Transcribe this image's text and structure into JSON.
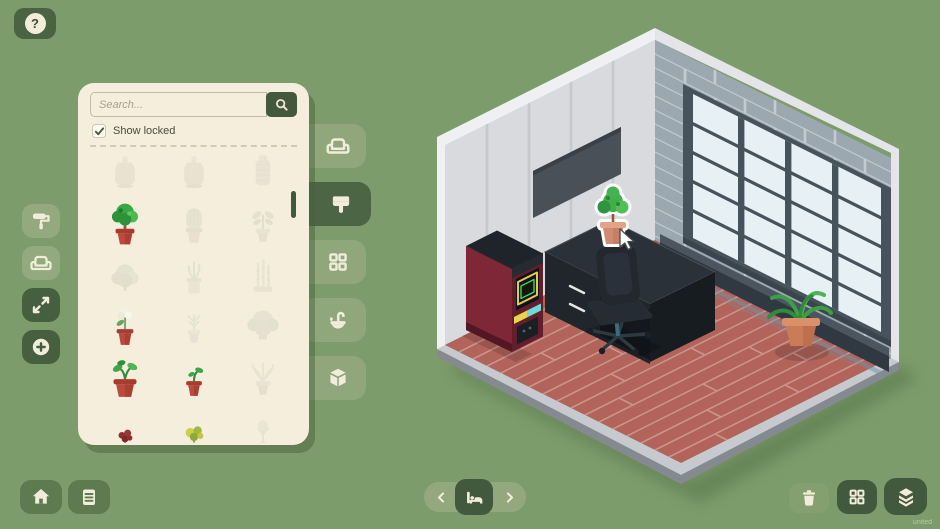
{
  "colors": {
    "background": "#7D9C6B",
    "panel": "#F6EEDD",
    "dark_green": "#46603F",
    "mid_green": "#92AA7D",
    "pot_red": "#B94A3D",
    "floor_brick": "#B2635A",
    "wall_left": "#D9DADD",
    "wall_right": "#9CA8B0"
  },
  "help": {
    "label": "?"
  },
  "left_toolbar": {
    "buttons": [
      {
        "icon": "paint-roller-icon"
      },
      {
        "icon": "sofa-icon"
      },
      {
        "icon": "expand-icon"
      },
      {
        "icon": "add-icon"
      }
    ]
  },
  "browser_panel": {
    "search": {
      "placeholder": "Search...",
      "value": "",
      "button_icon": "search-icon"
    },
    "show_locked": {
      "label": "Show locked",
      "checked": true
    },
    "tabs": [
      {
        "icon": "sofa-icon",
        "active": false
      },
      {
        "icon": "paint-brush-icon",
        "active": true
      },
      {
        "icon": "window-grid-icon",
        "active": false
      },
      {
        "icon": "sink-icon",
        "active": false
      },
      {
        "icon": "storage-box-icon",
        "active": false
      }
    ],
    "items": [
      {
        "kind": "vase-tall",
        "locked": true
      },
      {
        "kind": "vase-tall",
        "locked": true
      },
      {
        "kind": "vase-ribbed",
        "locked": true
      },
      {
        "kind": "tree-pot",
        "locked": false
      },
      {
        "kind": "cactus",
        "locked": true
      },
      {
        "kind": "plant-leafy",
        "locked": true
      },
      {
        "kind": "bush",
        "locked": true
      },
      {
        "kind": "plant-square-pot",
        "locked": true
      },
      {
        "kind": "bamboo",
        "locked": true
      },
      {
        "kind": "flower-white",
        "locked": false
      },
      {
        "kind": "plant-thin",
        "locked": true
      },
      {
        "kind": "plant-wide",
        "locked": true
      },
      {
        "kind": "sprout-large",
        "locked": false
      },
      {
        "kind": "sprout-small",
        "locked": false
      },
      {
        "kind": "plant-fern",
        "locked": true
      },
      {
        "kind": "bud-red",
        "locked": false
      },
      {
        "kind": "plant-yellow",
        "locked": false
      },
      {
        "kind": "plant-pale",
        "locked": true
      }
    ]
  },
  "bottom_bar": {
    "left": [
      {
        "icon": "home-icon"
      },
      {
        "icon": "notes-icon"
      }
    ],
    "center": {
      "prev_icon": "chevron-left-icon",
      "room_icon": "bed-icon",
      "next_icon": "chevron-right-icon"
    },
    "right": [
      {
        "icon": "trash-icon"
      },
      {
        "icon": "grid-view-icon"
      },
      {
        "icon": "layers-icon"
      }
    ]
  },
  "scene": {
    "objects": [
      "left-wall",
      "right-wall",
      "window",
      "wall-screen",
      "window-bench",
      "arcade-machine",
      "desk",
      "office-chair",
      "dragged-plant",
      "floor-plant",
      "cursor-pointer"
    ]
  },
  "version_label": "united"
}
